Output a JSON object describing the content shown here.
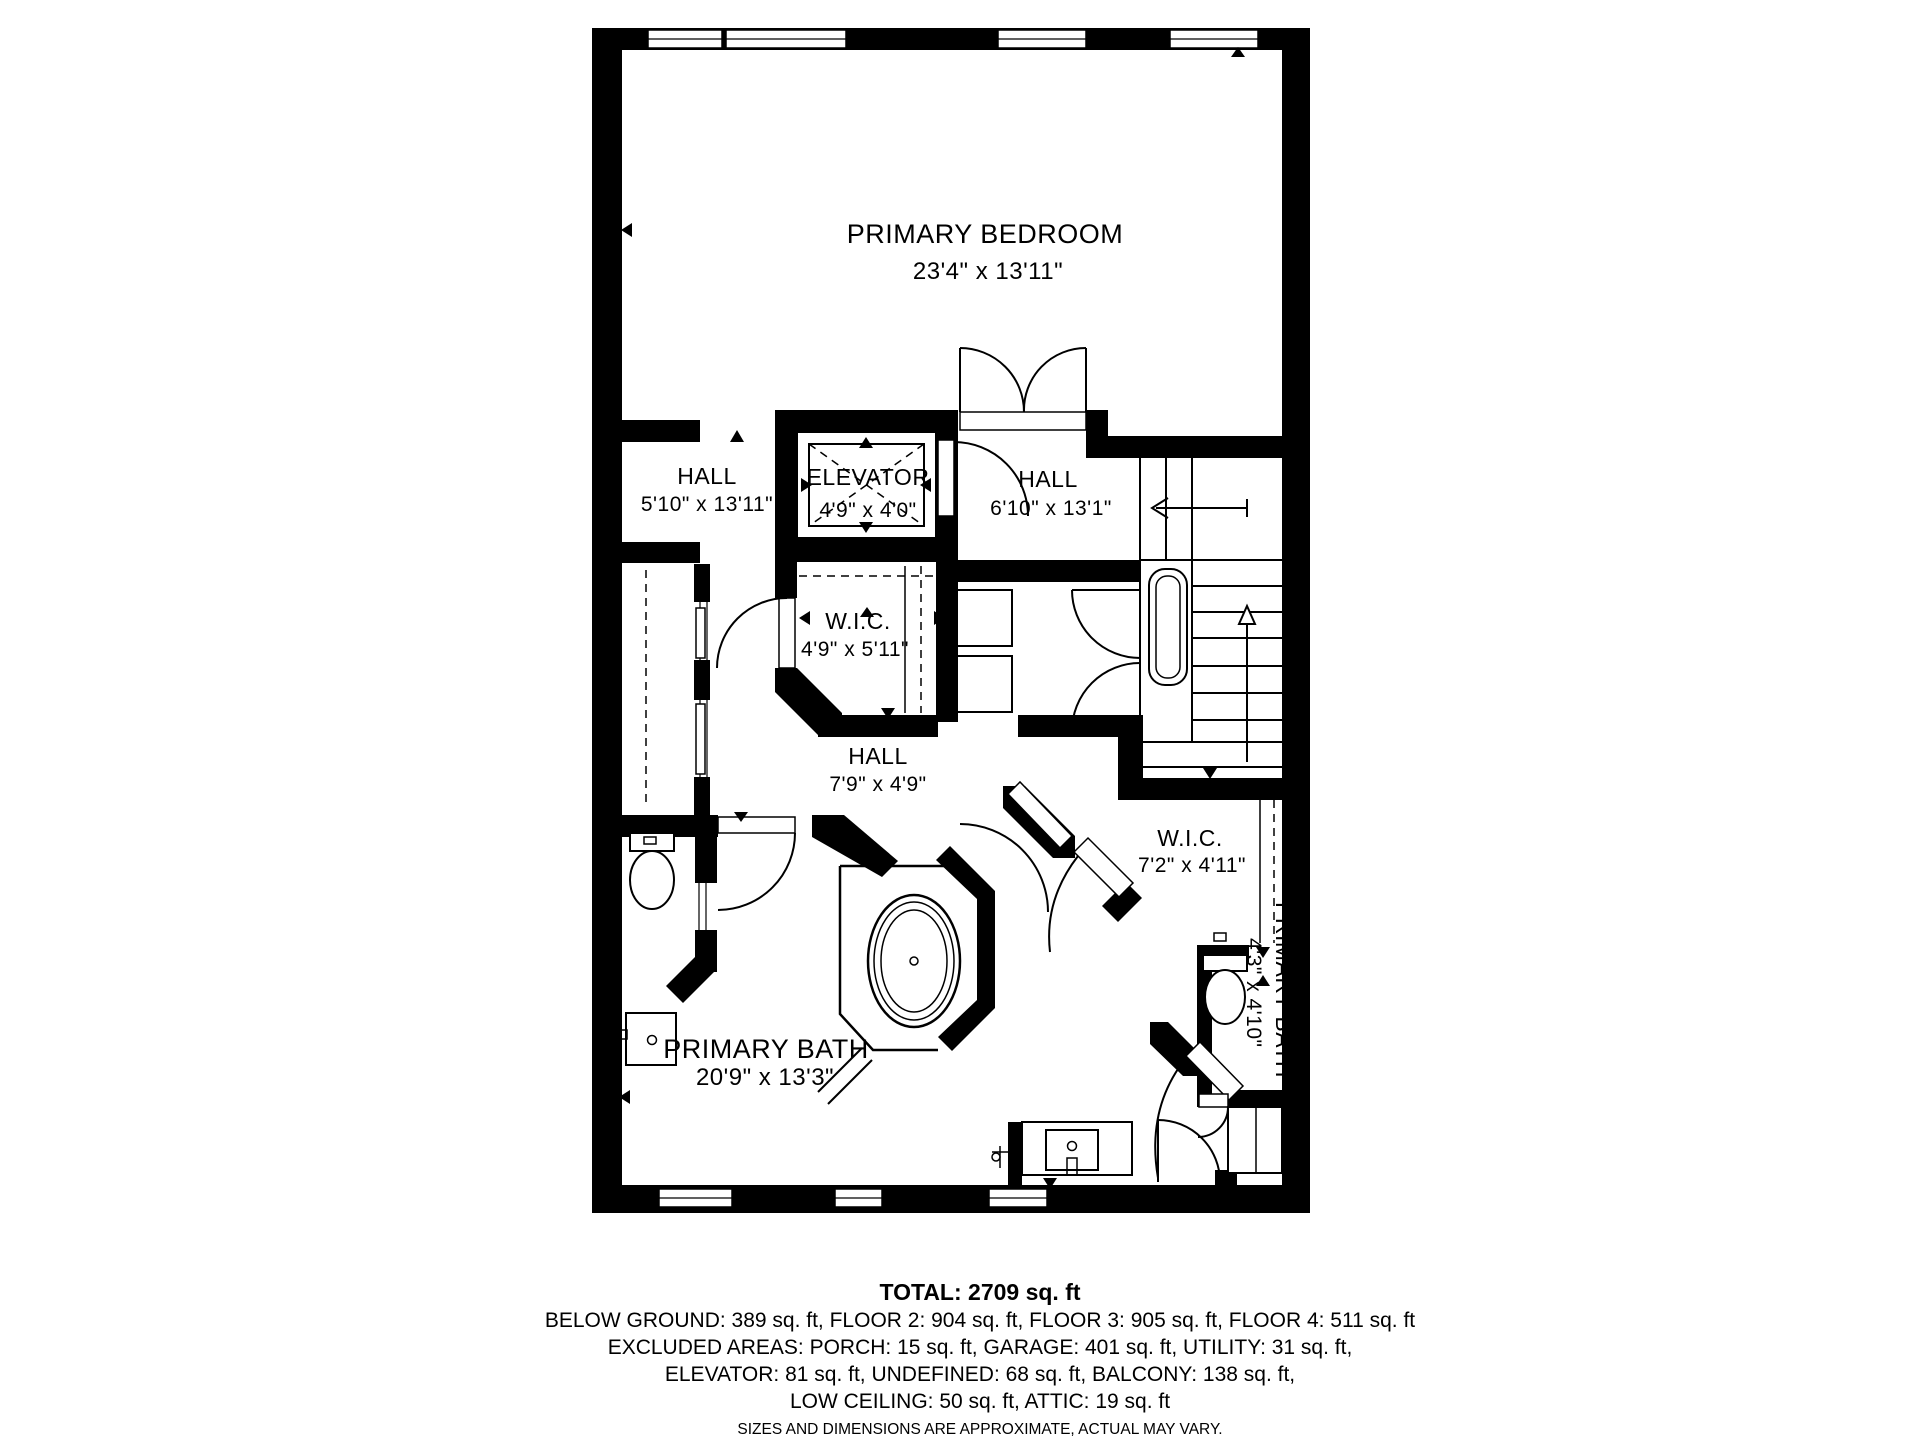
{
  "colors": {
    "ink": "#000000",
    "background": "#ffffff"
  },
  "rooms": {
    "primary_bedroom": {
      "name": "PRIMARY BEDROOM",
      "dims": "23'4\" x 13'11\""
    },
    "hall_left": {
      "name": "HALL",
      "dims": "5'10\" x 13'11\""
    },
    "elevator": {
      "name": "ELEVATOR",
      "dims": "4'9\" x 4'0\""
    },
    "hall_right": {
      "name": "HALL",
      "dims": "6'10\" x 13'1\""
    },
    "wic_center": {
      "name": "W.I.C.",
      "dims": "4'9\" x 5'11\""
    },
    "hall_center": {
      "name": "HALL",
      "dims": "7'9\" x 4'9\""
    },
    "wic_right": {
      "name": "W.I.C.",
      "dims": "7'2\" x 4'11\""
    },
    "primary_bath": {
      "name": "PRIMARY BATH",
      "dims": "20'9\" x 13'3\""
    },
    "primary_bath_small": {
      "name": "PRIMARY BATH",
      "dims": "4'3\" x 4'10\""
    }
  },
  "summary": {
    "total": "TOTAL: 2709 sq. ft",
    "line1": "BELOW GROUND: 389 sq. ft, FLOOR 2: 904 sq. ft, FLOOR 3: 905 sq. ft, FLOOR 4: 511 sq. ft",
    "line2": "EXCLUDED AREAS: PORCH: 15 sq. ft, GARAGE: 401 sq. ft, UTILITY: 31 sq. ft,",
    "line3": "ELEVATOR: 81 sq. ft, UNDEFINED: 68 sq. ft, BALCONY: 138 sq. ft,",
    "line4": "LOW CEILING: 50 sq. ft, ATTIC: 19 sq. ft",
    "disclaimer": "SIZES AND DIMENSIONS ARE APPROXIMATE, ACTUAL MAY VARY."
  }
}
